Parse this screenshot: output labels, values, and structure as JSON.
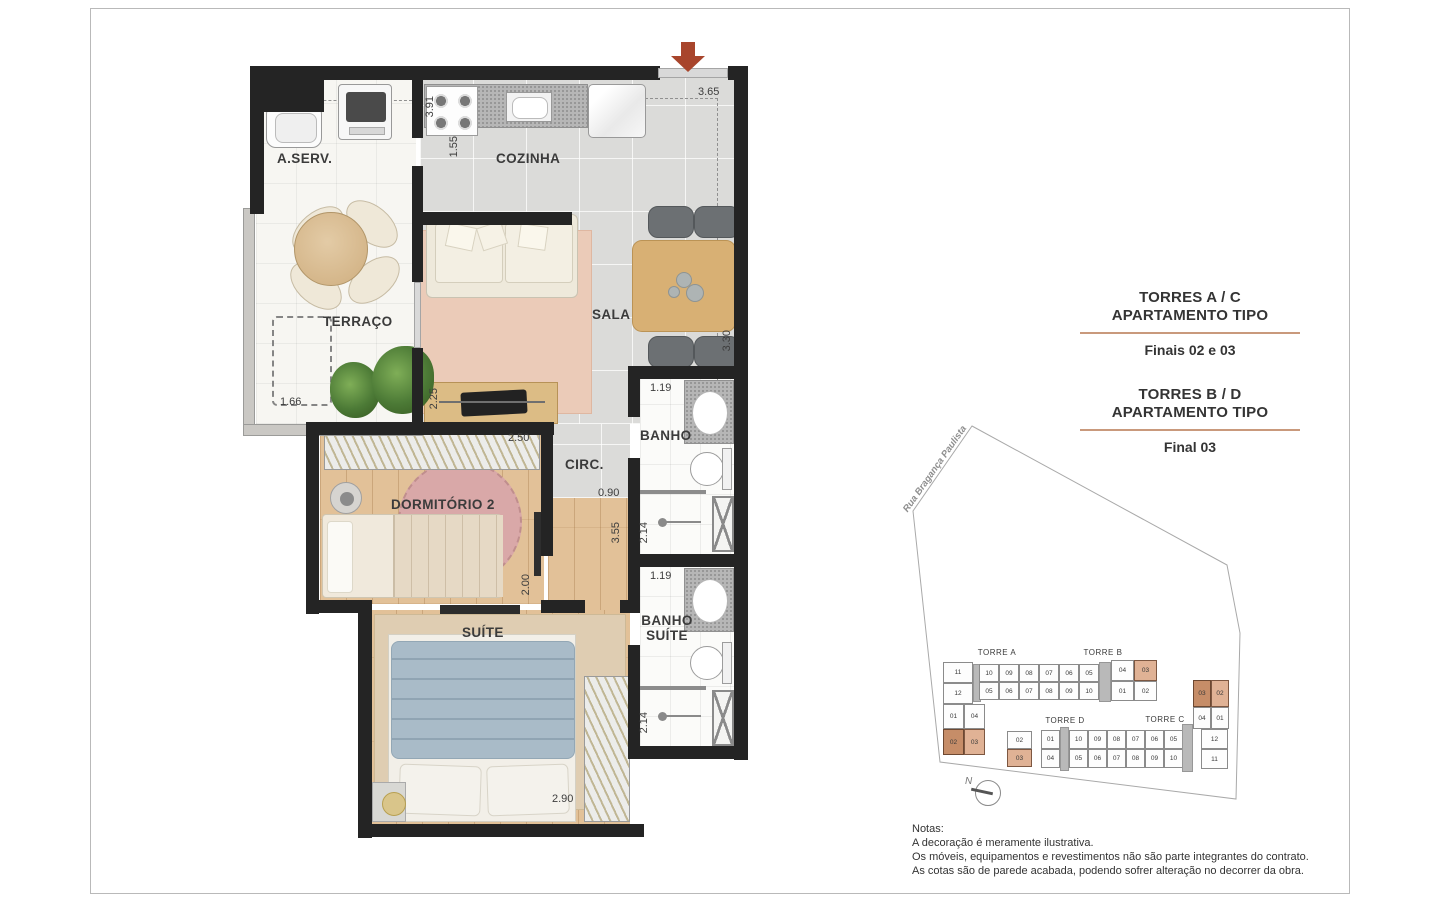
{
  "plan": {
    "rooms": {
      "aserv": "A.SERV.",
      "cozinha": "COZINHA",
      "terraco": "TERRAÇO",
      "sala": "SALA",
      "banho": "BANHO",
      "circ": "CIRC.",
      "dormitorio2": "DORMITÓRIO 2",
      "banho_suite_l1": "BANHO",
      "banho_suite_l2": "SUÍTE",
      "suite": "SUÍTE"
    },
    "dims": {
      "aserv_h": "3.91",
      "coz_left": "1.55",
      "coz_top": "3.65",
      "sala_right": "3.30",
      "terraco_w": "1.66",
      "sideboard": "2.25",
      "dorm2_w": "2.50",
      "dorm2_h": "2.00",
      "circ_w": "0.90",
      "hall_h": "3.55",
      "banho_w": "1.19",
      "banho_shower": "2.14",
      "bsuite_w": "1.19",
      "bsuite_shower": "2.14",
      "suite_w": "2.90"
    }
  },
  "info": {
    "b1_t1": "TORRES A / C",
    "b1_t2": "APARTAMENTO TIPO",
    "b1_sub": "Finais 02 e 03",
    "b2_t1": "TORRES B / D",
    "b2_t2": "APARTAMENTO TIPO",
    "b2_sub": "Final 03"
  },
  "site": {
    "street": "Rua Bragança Paulista",
    "north": "N",
    "torre_a": "TORRE A",
    "torre_b": "TORRE B",
    "torre_c": "TORRE C",
    "torre_d": "TORRE D",
    "ab_top": [
      {
        "n": "10"
      },
      {
        "n": "09"
      },
      {
        "n": "08"
      },
      {
        "n": "07"
      },
      {
        "n": "06"
      },
      {
        "n": "05"
      }
    ],
    "ab_top_end": [
      {
        "n": "04"
      },
      {
        "n": "03",
        "hl": 1
      }
    ],
    "ab_bottom": [
      {
        "n": "05"
      },
      {
        "n": "06"
      },
      {
        "n": "07"
      },
      {
        "n": "08"
      },
      {
        "n": "09"
      },
      {
        "n": "10"
      }
    ],
    "ab_bottom_end": [
      {
        "n": "01"
      },
      {
        "n": "02"
      }
    ],
    "ab_wing_col": [
      {
        "n": "11"
      },
      {
        "n": "12"
      }
    ],
    "ab_wing_row1": [
      {
        "n": "01"
      },
      {
        "n": "04"
      }
    ],
    "ab_wing_row2": [
      {
        "n": "02",
        "hl": 2
      },
      {
        "n": "03",
        "hl": 1
      }
    ],
    "dc_left": [
      {
        "n": "02"
      },
      {
        "n": "03",
        "hl": 1
      }
    ],
    "dc_top": [
      {
        "n": "01"
      },
      {
        "n": "10"
      },
      {
        "n": "09"
      },
      {
        "n": "08"
      },
      {
        "n": "07"
      },
      {
        "n": "06"
      },
      {
        "n": "05"
      }
    ],
    "dc_bottom": [
      {
        "n": "04"
      },
      {
        "n": "05"
      },
      {
        "n": "06"
      },
      {
        "n": "07"
      },
      {
        "n": "08"
      },
      {
        "n": "09"
      },
      {
        "n": "10"
      }
    ],
    "c_wing_row1": [
      {
        "n": "03",
        "hl": 2
      },
      {
        "n": "02",
        "hl": 1
      }
    ],
    "c_wing_row2": [
      {
        "n": "04"
      },
      {
        "n": "01"
      }
    ],
    "c_wing_col": [
      {
        "n": "12"
      },
      {
        "n": "11"
      }
    ]
  },
  "notes": {
    "title": "Notas:",
    "l1": "A decoração é meramente ilustrativa.",
    "l2": "Os móveis, equipamentos e revestimentos não são parte integrantes do contrato.",
    "l3": "As cotas são de parede acabada, podendo sofrer alteração no decorrer da obra."
  }
}
